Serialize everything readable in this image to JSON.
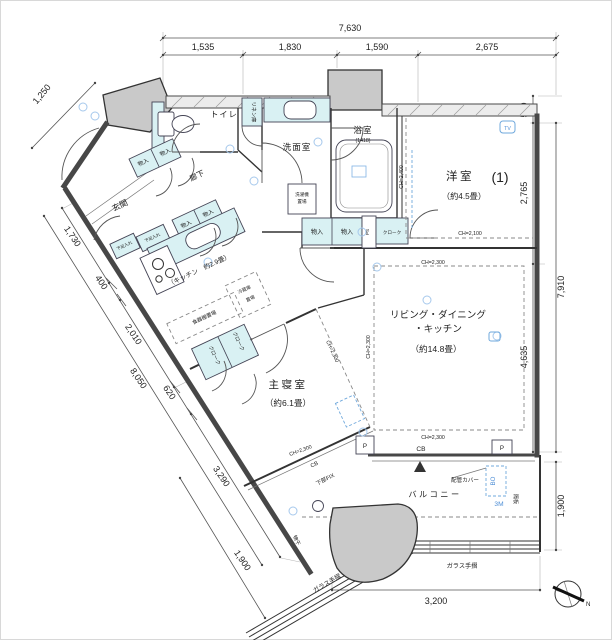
{
  "colors": {
    "wall": "#474747",
    "line": "#333333",
    "fixture_fill": "#d9f1f3",
    "concrete_fill": "#c9c9c9",
    "annotation_blue": "#4f8fd6",
    "background": "#ffffff"
  },
  "rooms": {
    "western": {
      "name": "洋室",
      "number": "(1)",
      "size": "（約4.5畳）",
      "ch_low": "CH=2,100",
      "ch_wall": "CH=2,400"
    },
    "ldk": {
      "name_line1": "リビング・ダイニング",
      "name_line2": "・キッチン",
      "size": "（約14.8畳）",
      "ch": "CH=2,300"
    },
    "kitchen": {
      "name": "（キッチン　約2.9畳）"
    },
    "master": {
      "name": "主寝室",
      "size": "（約6.1畳）",
      "ch": "CH=2,300"
    },
    "entrance": {
      "name": "玄関"
    },
    "hallway": {
      "name": "廊下"
    },
    "toilet": {
      "name": "トイレ"
    },
    "washroom": {
      "name": "洗面室"
    },
    "bathroom": {
      "name": "浴室",
      "size": "(1418)"
    },
    "balcony": {
      "name": "バルコニー"
    }
  },
  "fixtures": {
    "linen": "リネン庫",
    "storage": "物入",
    "shoe_box": "下足入れ",
    "cloak": "クローク",
    "dish_shelf": "食器棚置場",
    "fridge_line1": "冷蔵庫",
    "fridge_line2": "置場",
    "laundry_line1": "洗濯機",
    "laundry_line2": "置場",
    "ps": "PS",
    "pipe_cover": "配管カバー",
    "glass_rail": "ガラス手摺",
    "drying": "物干",
    "partition": "隔板",
    "fix_window": "下部FIX",
    "tv": "TV",
    "bo": "BO",
    "m3": "3M",
    "cb": "CB",
    "pillar": "P",
    "north": "N"
  },
  "dimensions": {
    "top_total": "7,630",
    "top_segments": [
      "1,535",
      "1,830",
      "1,590",
      "2,675"
    ],
    "right": [
      "540",
      "2,765",
      "4,635"
    ],
    "right_total": "7,910",
    "right_bottom": "1,900",
    "left": [
      "1,250",
      "1,730",
      "400",
      "2,010",
      "620",
      "3,290"
    ],
    "left_total": "8,050",
    "left_bottom": "1,900",
    "bottom": "3,200"
  }
}
